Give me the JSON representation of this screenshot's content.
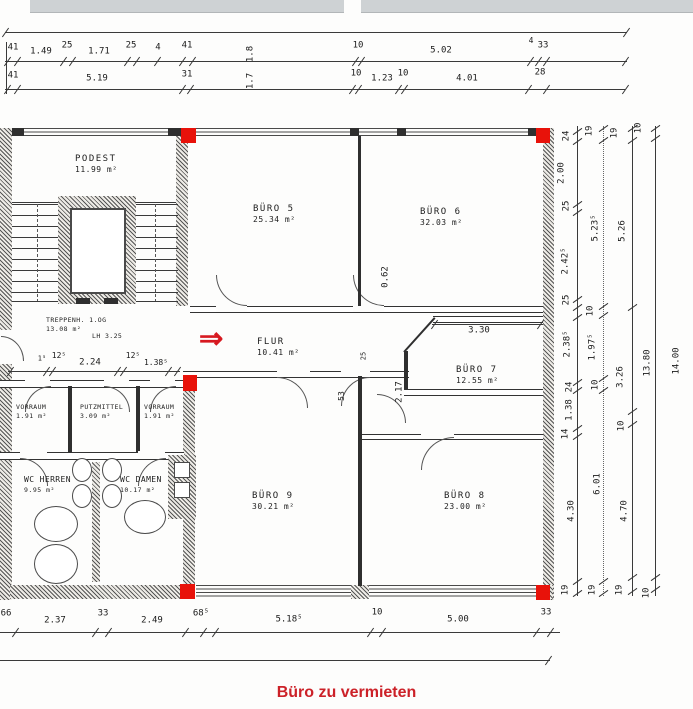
{
  "meta": {
    "type": "architectural-floor-plan",
    "floor": "1.OG office floor plan, scanned"
  },
  "colors": {
    "marker_red": "#e8120a",
    "arrow_red": "#d71920",
    "caption_red": "#cc2128",
    "line": "#333333"
  },
  "annotations": {
    "arrow": "⇒",
    "caption": "Büro zu vermieten"
  },
  "rooms": {
    "podest": {
      "name": "PODEST",
      "area": "11.99 m²"
    },
    "treppenhaus": {
      "name": "TREPPENH. 1.OG",
      "area": "13.08 m²",
      "note": "LH 3.25"
    },
    "flur": {
      "name": "FLUR",
      "area": "10.41 m²"
    },
    "buero5": {
      "name": "BÜRO 5",
      "area": "25.34 m²"
    },
    "buero6": {
      "name": "BÜRO 6",
      "area": "32.03 m²"
    },
    "buero7": {
      "name": "BÜRO 7",
      "area": "12.55 m²"
    },
    "buero8": {
      "name": "BÜRO 8",
      "area": "23.00 m²"
    },
    "buero9": {
      "name": "BÜRO 9",
      "area": "30.21 m²"
    },
    "vorraum_left": {
      "name": "VORRAUM",
      "area": "1.91 m²"
    },
    "putzmittel": {
      "name": "PUTZMITTEL",
      "area": "3.09 m²"
    },
    "vorraum_right": {
      "name": "VORRAUM",
      "area": "1.91 m²"
    },
    "wc_herren": {
      "name": "WC HERREN",
      "area": "9.95 m²"
    },
    "wc_damen": {
      "name": "WC DAMEN",
      "area": "10.17 m²"
    }
  },
  "dimensions": {
    "top_row1": [
      {
        "t": "41",
        "x": 13,
        "y": 48
      },
      {
        "t": "1.49",
        "x": 41,
        "y": 52
      },
      {
        "t": "25",
        "x": 67,
        "y": 46
      },
      {
        "t": "1.71",
        "x": 99,
        "y": 52
      },
      {
        "t": "25",
        "x": 131,
        "y": 46
      },
      {
        "t": "4",
        "x": 158,
        "y": 48
      },
      {
        "t": "41",
        "x": 187,
        "y": 46
      },
      {
        "t": "1.8",
        "x": 251,
        "y": 54,
        "r": -90
      },
      {
        "t": "10",
        "x": 358,
        "y": 46
      },
      {
        "t": "5.02",
        "x": 441,
        "y": 51
      },
      {
        "t": "4",
        "x": 531,
        "y": 41,
        "s": 8
      },
      {
        "t": "33",
        "x": 543,
        "y": 46
      }
    ],
    "top_row2": [
      {
        "t": "41",
        "x": 13,
        "y": 76
      },
      {
        "t": "5.19",
        "x": 97,
        "y": 79
      },
      {
        "t": "31",
        "x": 187,
        "y": 75
      },
      {
        "t": "1.7",
        "x": 251,
        "y": 81,
        "r": -90
      },
      {
        "t": "10",
        "x": 356,
        "y": 74
      },
      {
        "t": "1.23",
        "x": 382,
        "y": 79
      },
      {
        "t": "10",
        "x": 403,
        "y": 74
      },
      {
        "t": "4.01",
        "x": 467,
        "y": 79
      },
      {
        "t": "28",
        "x": 540,
        "y": 73
      }
    ],
    "inner": [
      {
        "t": "0.62",
        "x": 386,
        "y": 277,
        "r": -90
      },
      {
        "t": "3.30",
        "x": 479,
        "y": 331
      },
      {
        "t": "2.17",
        "x": 400,
        "y": 392,
        "r": -90
      },
      {
        "t": "53",
        "x": 342,
        "y": 396,
        "r": -90,
        "s": 8
      },
      {
        "t": "25",
        "x": 364,
        "y": 356,
        "r": -90,
        "s": 7
      },
      {
        "t": "1⁵",
        "x": 42,
        "y": 359,
        "s": 7
      },
      {
        "t": "12⁵",
        "x": 59,
        "y": 356,
        "s": 8
      },
      {
        "t": "2.24",
        "x": 90,
        "y": 363
      },
      {
        "t": "12⁵",
        "x": 133,
        "y": 356,
        "s": 8
      },
      {
        "t": "1.38⁵",
        "x": 156,
        "y": 363,
        "s": 8
      }
    ],
    "bottom": [
      {
        "t": "66",
        "x": 6,
        "y": 614
      },
      {
        "t": "2.37",
        "x": 55,
        "y": 621
      },
      {
        "t": "33",
        "x": 103,
        "y": 614
      },
      {
        "t": "2.49",
        "x": 152,
        "y": 621
      },
      {
        "t": "68⁵",
        "x": 201,
        "y": 614
      },
      {
        "t": "5.18⁵",
        "x": 289,
        "y": 620
      },
      {
        "t": "10",
        "x": 377,
        "y": 613
      },
      {
        "t": "5.00",
        "x": 458,
        "y": 620
      },
      {
        "t": "33",
        "x": 546,
        "y": 613
      }
    ],
    "right_chain1": [
      {
        "t": "24",
        "x": 567,
        "y": 136,
        "r": -90
      },
      {
        "t": "2.00",
        "x": 562,
        "y": 173,
        "r": -90
      },
      {
        "t": "25",
        "x": 567,
        "y": 206,
        "r": -90
      },
      {
        "t": "2.42⁵",
        "x": 566,
        "y": 261,
        "r": -90
      },
      {
        "t": "25",
        "x": 567,
        "y": 300,
        "r": -90
      },
      {
        "t": "2.38⁵",
        "x": 568,
        "y": 344,
        "r": -90
      },
      {
        "t": "24",
        "x": 570,
        "y": 387,
        "r": -90
      },
      {
        "t": "1.38",
        "x": 570,
        "y": 410,
        "r": -90
      },
      {
        "t": "14",
        "x": 566,
        "y": 434,
        "r": -90
      },
      {
        "t": "4.30",
        "x": 572,
        "y": 511,
        "r": -90
      },
      {
        "t": "19",
        "x": 566,
        "y": 590,
        "r": -90
      }
    ],
    "right_chain2": [
      {
        "t": "19",
        "x": 590,
        "y": 131,
        "r": -90
      },
      {
        "t": "5.23⁵",
        "x": 596,
        "y": 228,
        "r": -90
      },
      {
        "t": "10",
        "x": 591,
        "y": 311,
        "r": -90
      },
      {
        "t": "1.97⁵",
        "x": 593,
        "y": 347,
        "r": -90
      },
      {
        "t": "10",
        "x": 596,
        "y": 385,
        "r": -90
      },
      {
        "t": "6.01",
        "x": 598,
        "y": 484,
        "r": -90
      },
      {
        "t": "19",
        "x": 593,
        "y": 590,
        "r": -90
      }
    ],
    "right_chain3": [
      {
        "t": "19",
        "x": 615,
        "y": 133,
        "r": -90
      },
      {
        "t": "5.26",
        "x": 623,
        "y": 231,
        "r": -90
      },
      {
        "t": "3.26",
        "x": 621,
        "y": 377,
        "r": -90
      },
      {
        "t": "10",
        "x": 622,
        "y": 426,
        "r": -90
      },
      {
        "t": "4.70",
        "x": 625,
        "y": 511,
        "r": -90
      },
      {
        "t": "19",
        "x": 620,
        "y": 590,
        "r": -90
      }
    ],
    "right_chain4": [
      {
        "t": "10",
        "x": 639,
        "y": 128,
        "r": -90
      },
      {
        "t": "13.80",
        "x": 648,
        "y": 363,
        "r": -90
      },
      {
        "t": "10",
        "x": 647,
        "y": 593,
        "r": -90
      },
      {
        "t": "14.00",
        "x": 677,
        "y": 361,
        "r": -90
      }
    ]
  },
  "markers": {
    "red_squares": [
      {
        "x": 181,
        "y": 128,
        "w": 15,
        "h": 15
      },
      {
        "x": 536,
        "y": 128,
        "w": 14,
        "h": 15
      },
      {
        "x": 183,
        "y": 375,
        "w": 14,
        "h": 16
      },
      {
        "x": 180,
        "y": 584,
        "w": 15,
        "h": 15
      },
      {
        "x": 536,
        "y": 585,
        "w": 14,
        "h": 15
      }
    ]
  }
}
